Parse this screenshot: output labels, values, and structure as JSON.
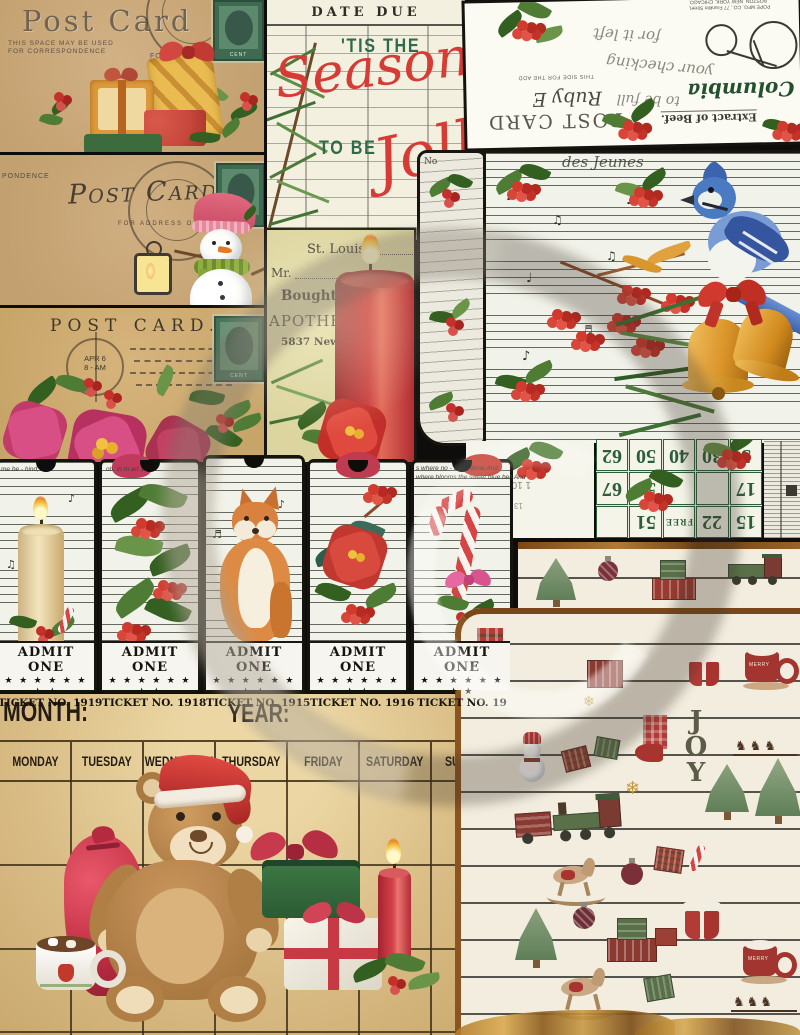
{
  "artwork": {
    "description": "Christmas junk journal printable collage"
  },
  "stamp_label": "CENT",
  "postcard_gifts": {
    "title": "Post Card",
    "note1": "THIS SPACE MAY BE USED",
    "note2": "FOR CORRESPONDENCE",
    "address": "FOR ADDR"
  },
  "postcard_snowman": {
    "title": "Post Card",
    "address": "FOR ADDRESS ONLY",
    "edge": "PONDENCE"
  },
  "postcard_poinsettia": {
    "title": "POST CARD.",
    "postmark1": "APR 6",
    "postmark2": "8 - AM"
  },
  "library_card": {
    "header": "DATE DUE",
    "tis": "'TIS THE",
    "season": "Season",
    "tobe": "TO BE",
    "jolly": "Jolly"
  },
  "receipt": {
    "city": "St. Louis,",
    "mr": "Mr.",
    "bought": "Bought of J. G. OEHR",
    "business": "APOTHECARY  AND  DR",
    "street": "5837 New M"
  },
  "ephemera": {
    "postcard": "POST CARD",
    "columbia": "Columbia",
    "ruby": "Ruby E",
    "extract": "Extract  of Beef.",
    "side": "THIS SIDE FOR THE ADD",
    "print1": "POPE MFG. CO., 77 Franklin Street,",
    "print2": "BOSTON, NEW YORK, CHICAGO.",
    "script1": "for it left",
    "script2": "your checking",
    "script3": "to be full"
  },
  "music_card": {
    "no": "No",
    "lyric": "des  Jeunes"
  },
  "bingo": {
    "rows": [
      [
        "62",
        "50",
        "40",
        "30",
        "3"
      ],
      [
        "67",
        "56",
        "",
        "",
        "17"
      ],
      [
        "",
        "51",
        "FREE",
        "22",
        "15"
      ]
    ],
    "fragment1": "1 100",
    "fragment2": "13 1954"
  },
  "tickets": {
    "admit": "ADMIT ONE",
    "stars": "★ ★ ★ ★ ★ ★ ★ ★",
    "lyric1": "me be - hind, an",
    "lyric2": "oh, in m        art 1",
    "lyric5a": "s where  no - b        are done,And",
    "lyric5b": "where blooms the sweet blue bell,And",
    "items": [
      {
        "number": "TICKET NO. 1919"
      },
      {
        "number": "TICKET NO. 1918"
      },
      {
        "number": "TICKET NO. 1915"
      },
      {
        "number": "TICKET NO. 1916"
      },
      {
        "number": "TICKET NO. 19"
      }
    ]
  },
  "calendar": {
    "month": "MONTH:",
    "year": "YEAR:",
    "days": [
      "MONDAY",
      "TUESDAY",
      "WEDNESDAY",
      "THURSDAY",
      "FRIDAY",
      "SATURDAY",
      "SUNDAY"
    ]
  },
  "pattern_paper": {
    "joy_letters": [
      "J",
      "O",
      "Y"
    ],
    "mug_text": "MERRY"
  }
}
